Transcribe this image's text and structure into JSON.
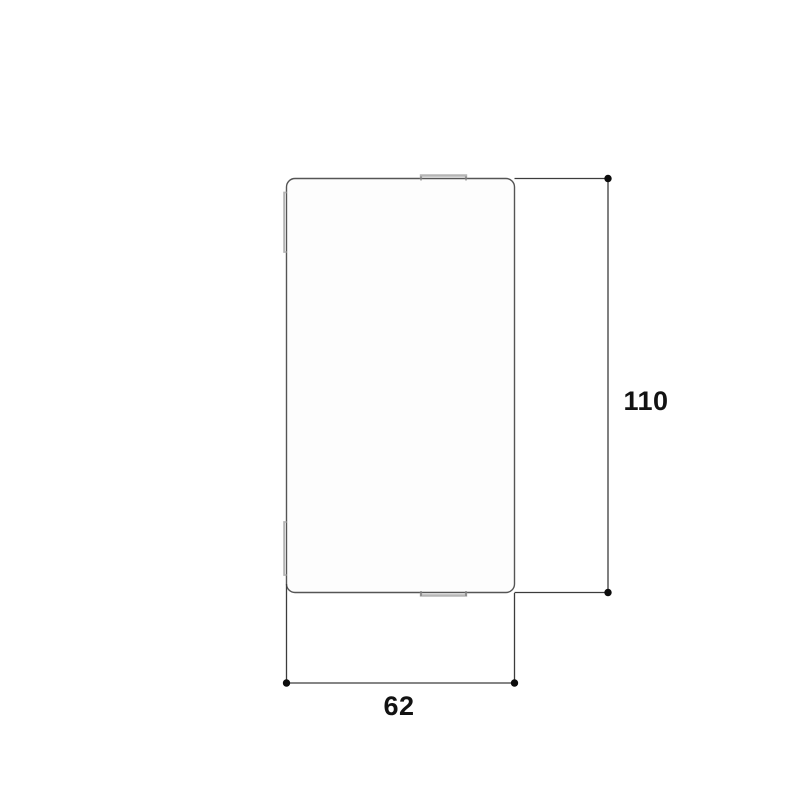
{
  "diagram": {
    "kind": "dimension-drawing",
    "labels": {
      "height": "110",
      "width": "62"
    },
    "colors": {
      "background": "#ffffff",
      "panel_outline": "#555555",
      "panel_fill": "#fdfdfd",
      "notch_tab": "#b5b5b5",
      "notch_tick": "#6a6a6a",
      "dimension_line": "#3c3c3c",
      "endpoint_dot": "#0c0c0c",
      "label_text": "#121212"
    }
  }
}
